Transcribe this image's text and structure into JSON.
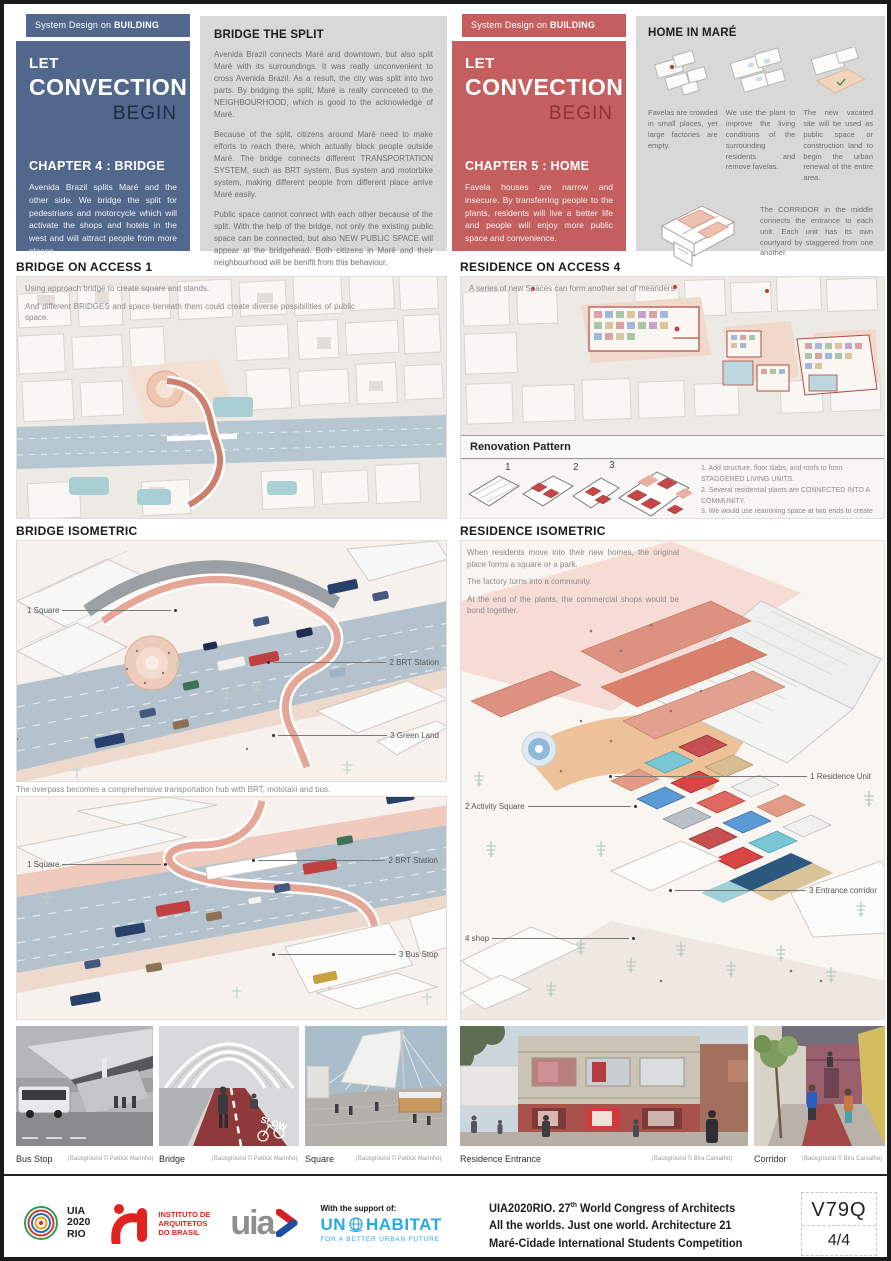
{
  "colors": {
    "blue": "#51688c",
    "navy": "#1e2a40",
    "red": "#c55f5f",
    "dark_red": "#8e3232",
    "graybox": "#d8d8d8"
  },
  "headers": {
    "band_prefix": "System Design on ",
    "band_bold": "BUILDING SCALE",
    "title_l1": "LET",
    "title_l2": "CONVECTION",
    "title_l3": "BEGIN",
    "left": {
      "chapter": "CHAPTER 4 : BRIDGE",
      "text": "Avenida Brazil splits Maré and the other side. We bridge the split for pedestrians and motorcycle which will activate the shops and hotels in the west and will attract people from more places."
    },
    "right": {
      "chapter": "CHAPTER 5 : HOME",
      "text": "Favela houses are narrow and insecure. By transferring people to the plants, residents will live a better life and people will enjoy more public space and convenience."
    }
  },
  "bridge_split": {
    "title": "BRIDGE THE SPLIT",
    "p1": "Avenida Brazil connects Maré and downtown, but also split Maré with its surroundings. It was really unconvenient to cross Avenida Brazil. As a result, the city was split into two parts. By bridging the split, Maré is really connceted to the NEIGHBOURHOOD, which is good to the acknowledge of Maré.",
    "p2": "Because of the split, citizens around Maré need to make efforts to reach there, which actually block people outside Maré. The bridge connects different TRANSPORTATION SYSTEM, such as BRT system, Bus system and motorbike system, making different people from different place arrive Maré easily.",
    "p3": "Public space cannot connect with each other because of the split. With the help of the bridge, not only the existing public space can be connected, but also NEW PUBLIC SPACE will appear at the bridgehead. Both citizens in Maré and their neighbourhood will be benifit from this behaviour.",
    "p4": "Through this facility, the vitality in Maré must be noticed. The overpass is the entrance not only to reach Maré but also to know Maré."
  },
  "home_in_mare": {
    "title": "HOME IN MARÉ",
    "cap1": "Favelas are crowded in small places, yet large factories are empty.",
    "cap2": "We use the plant to improve the living conditions of the surrounding residents and remove favelas.",
    "cap3": "The new vacated site will be used as public space or construction land to begin the urban renewal of the entire area.",
    "corridor_note": "The CORRIDOR in the middle connects the entrance to each unit. Each unit has its own courtyard by staggered from one another."
  },
  "bridge_access": {
    "title": "BRIDGE ON ACCESS 1",
    "line1": "Using approach bridge to create square and stands.",
    "line2": "And different BRIDGES and space beneath them could create diverse possibilities of public space."
  },
  "residence_access": {
    "title": "RESIDENCE ON ACCESS 4",
    "line1": "A series of new Spaces can form another set of meanders.",
    "renovation": {
      "title": "Renovation Pattern",
      "num1": "1",
      "num2": "2",
      "num3": "3",
      "note1": "1. Add structure, floor slabs, and roofs to form STAGGERED LIVING UNITS.",
      "note2": "2. Several residential plants are CONNECTED INTO A COMMUNITY.",
      "note3": "3. We would use reamining space at two ends to create shops and PUBLIC SERVICE, which is adjacent to the entrance."
    }
  },
  "bridge_isometric": {
    "title": "BRIDGE ISOMETRIC",
    "v1_l1": "1  Square",
    "v1_l2": "2  BRT Station",
    "v1_l3": "3  Green Land",
    "caption": "The overpass becomes a comprehensive transportation hub with BRT, mototaxi and bus.",
    "v2_l1": "1  Square",
    "v2_l2": "2  BRT Station",
    "v2_l3": "3  Bus Stop"
  },
  "residence_isometric": {
    "title": "RESIDENCE ISOMETRIC",
    "p1": "When residents move into their new homes, the original place forms a square or a park.",
    "p2": "The factory turns into a community.",
    "p3": "At the end of the plants, the commercial shops would be bond together.",
    "l1": "1  Residence Unit",
    "l2": "2  Activity Square",
    "l3": "3  Entrance corridor",
    "l4": "4  shop"
  },
  "photos": [
    {
      "label": "Bus Stop",
      "credit": "(Background © Patrick Marinho)"
    },
    {
      "label": "Bridge",
      "credit": "(Background © Patrick Marinho)",
      "marking": "SLOW"
    },
    {
      "label": "Square",
      "credit": "(Background © Patrick Marinho)"
    },
    {
      "label": "Residence Entrance",
      "credit": "(Background © Bira Carvalho)"
    },
    {
      "label": "Corridor",
      "credit": "(Background © Bira Carvalho)"
    }
  ],
  "footer": {
    "uia_l1": "UIA",
    "uia_l2": "2020",
    "uia_l3": "RIO",
    "iab_l1": "INSTITUTO DE",
    "iab_l2": "ARQUITETOS",
    "iab_l3": "DO BRASIL",
    "uia_wordmark": "uia",
    "support": "With the support of:",
    "un": "UN",
    "habitat": "HABITAT",
    "un_tagline": "FOR A BETTER URBAN FUTURE",
    "congress_l1a": "UIA2020RIO. 27",
    "congress_l1_sup": "th",
    "congress_l1b": " World Congress of Architects",
    "congress_l2": "All the worlds. Just one world. Architecture 21",
    "congress_l3": "Maré-Cidade International Students Competition",
    "code": "V79Q",
    "page": "4/4"
  }
}
